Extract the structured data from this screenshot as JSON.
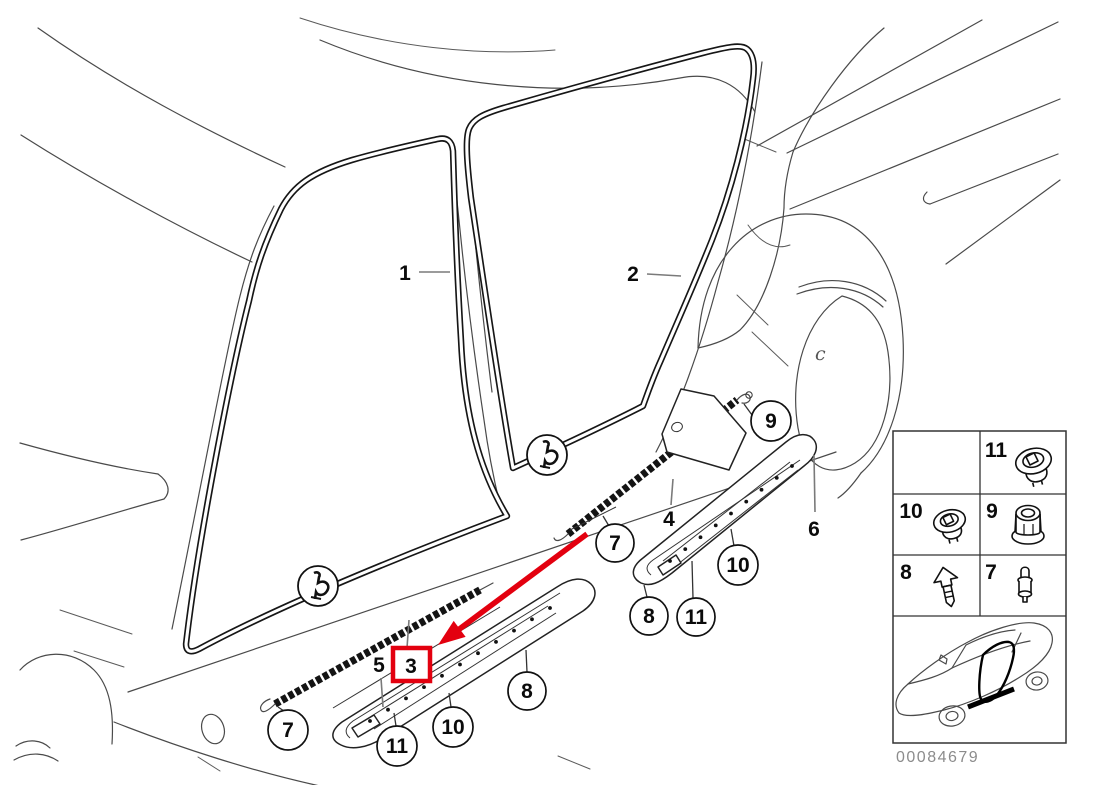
{
  "diagram": {
    "description": "vehicle-door-sill-trim-exploded-diagram",
    "colors": {
      "accent_red": "#e3000f",
      "line": "#4a4a4a",
      "label": "#0b0b0b",
      "leader_gray": "#7a7a7a",
      "leader_dark": "#333333"
    },
    "plain_callouts": [
      {
        "id": "1",
        "label": "1",
        "x": 405,
        "y": 272,
        "leader": [
          419,
          272,
          450,
          272
        ]
      },
      {
        "id": "2",
        "label": "2",
        "x": 633,
        "y": 273,
        "leader": [
          647,
          274,
          681,
          276
        ]
      },
      {
        "id": "4",
        "label": "4",
        "x": 669,
        "y": 518,
        "leader": [
          671,
          505,
          673,
          479
        ]
      },
      {
        "id": "5",
        "label": "5",
        "x": 379,
        "y": 664,
        "leader": [
          381,
          678,
          383,
          707
        ]
      },
      {
        "id": "6",
        "label": "6",
        "x": 814,
        "y": 528,
        "leader": [
          815,
          512,
          814,
          455
        ]
      }
    ],
    "circled_callouts": [
      {
        "id": "7-front",
        "label": "7",
        "cx": 288,
        "cy": 730,
        "r": 20,
        "leader": [
          284,
          711,
          278,
          707
        ]
      },
      {
        "id": "11-front",
        "label": "11",
        "cx": 397,
        "cy": 746,
        "r": 20,
        "leader": [
          396,
          726,
          394,
          713
        ]
      },
      {
        "id": "10-front",
        "label": "10",
        "cx": 453,
        "cy": 727,
        "r": 20,
        "leader": [
          451,
          707,
          449,
          693
        ]
      },
      {
        "id": "8-front",
        "label": "8",
        "cx": 527,
        "cy": 691,
        "r": 19,
        "leader": [
          527,
          672,
          526,
          650
        ]
      },
      {
        "id": "7-rear",
        "label": "7",
        "cx": 615,
        "cy": 543,
        "r": 19,
        "leader": [
          609,
          526,
          603,
          516
        ]
      },
      {
        "id": "9",
        "label": "9",
        "cx": 771,
        "cy": 421,
        "r": 20,
        "leader": [
          752,
          415,
          744,
          404
        ]
      },
      {
        "id": "10-rear",
        "label": "10",
        "cx": 738,
        "cy": 565,
        "r": 20,
        "leader": [
          734,
          546,
          731,
          529
        ]
      },
      {
        "id": "8-rear",
        "label": "8",
        "cx": 649,
        "cy": 616,
        "r": 19,
        "leader": [
          647,
          597,
          644,
          585
        ]
      },
      {
        "id": "11-rear",
        "label": "11",
        "cx": 696,
        "cy": 617,
        "r": 19,
        "leader": [
          693,
          598,
          692,
          561
        ]
      }
    ],
    "highlight": {
      "label": "3",
      "box": {
        "x": 393,
        "y": 648,
        "w": 37,
        "h": 33
      },
      "label_x": 411,
      "label_y": 665,
      "leader": [
        407,
        648,
        409,
        620
      ],
      "arrow": {
        "x1": 587,
        "y1": 534,
        "tip_x": 438,
        "tip_y": 645,
        "shaft_w": 5.5,
        "head_l": 27,
        "head_w": 20
      }
    },
    "legend": {
      "frame": {
        "x": 893,
        "y": 431,
        "w": 173,
        "h": 312
      },
      "col_split_x": 980,
      "row_line_ys": [
        494,
        555,
        616
      ],
      "cells": [
        {
          "label": "11",
          "icon": "grommet-nut-icon",
          "num_x": 996,
          "num_y": 457
        },
        {
          "label": "10",
          "icon": "grommet-icon",
          "num_x": 911,
          "num_y": 518
        },
        {
          "label": "9",
          "icon": "flange-nut-icon",
          "num_x": 992,
          "num_y": 518
        },
        {
          "label": "8",
          "icon": "expansion-rivet-icon",
          "num_x": 906,
          "num_y": 579
        },
        {
          "label": "7",
          "icon": "plug-clip-icon",
          "num_x": 991,
          "num_y": 579
        }
      ],
      "part_number": "00084679"
    },
    "wheel_mark": "c"
  }
}
